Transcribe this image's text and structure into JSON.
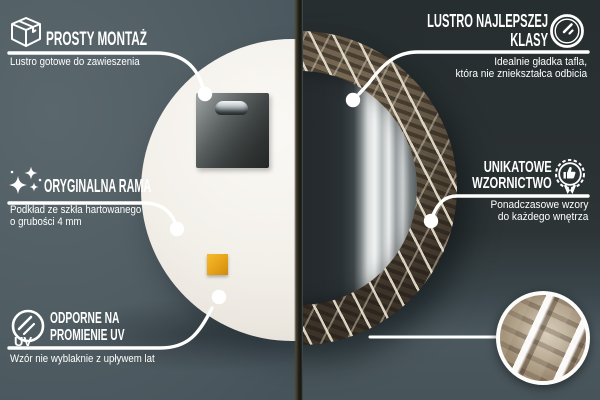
{
  "callouts": {
    "easy_mounting": {
      "icon": "package-box-icon",
      "title": "PROSTY MONTAŻ",
      "subtitle": "Lustro gotowe do zawieszenia"
    },
    "original_frame": {
      "icon": "sparkles-icon",
      "title": "ORYGINALNA RAMA",
      "subtitle_line1": "Podkład ze szkła hartowanego",
      "subtitle_line2": "o grubości 4 mm"
    },
    "uv_resistant": {
      "icon": "uv-circle-icon",
      "icon_label": "UV",
      "title_line1": "ODPORNE NA",
      "title_line2": "PROMIENIE UV",
      "subtitle": "Wzór nie wyblaknie z upływem lat"
    },
    "top_class_mirror": {
      "icon": "mirror-shine-icon",
      "title_line1": "LUSTRO NAJLEPSZEJ",
      "title_line2": "KLASY",
      "subtitle_line1": "Idealnie gładka tafla,",
      "subtitle_line2": "która nie zniekształca odbicia"
    },
    "unique_design": {
      "icon": "award-badge-icon",
      "title_line1": "UNIKATOWE",
      "title_line2": "WZORNICTWO",
      "subtitle_line1": "Ponadczasowe wzory",
      "subtitle_line2": "do każdego wnętrza"
    }
  },
  "colors": {
    "wall_left": "#4e5b60",
    "wall_right_top": "#2b3234",
    "wall_bottom": "#4a575d",
    "callout_white": "#ffffff",
    "mirror_back_white": "#f2efe8",
    "frame_steel_brown": "#473d31",
    "mounting_pad_orange": "#e9a41d"
  }
}
